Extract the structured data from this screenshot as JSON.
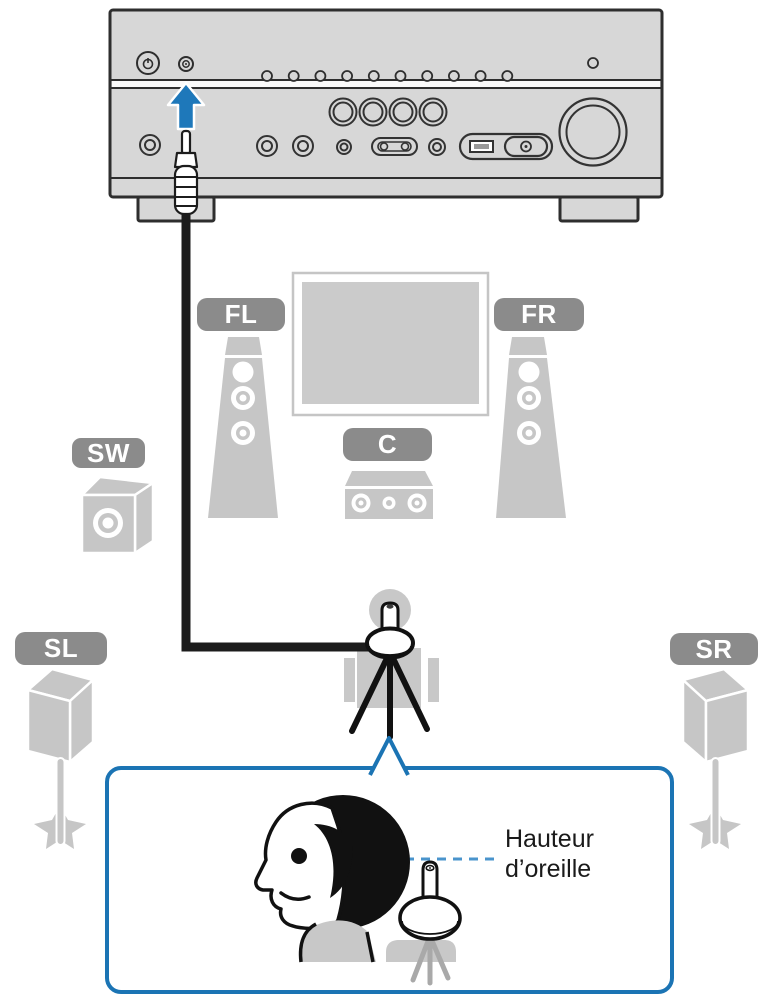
{
  "labels": {
    "front_left": "FL",
    "front_right": "FR",
    "center": "C",
    "subwoofer": "SW",
    "surround_left": "SL",
    "surround_right": "SR"
  },
  "callout": {
    "line1": "Hauteur",
    "line2": "d’oreille"
  },
  "colors": {
    "accent_blue": "#1e78ba",
    "callout_border": "#1b74b4",
    "dashed_line_blue": "#4a94cc",
    "label_badge_gray": "#8b8b8b",
    "speaker_gray": "#c6c6c6",
    "receiver_gray": "#d7d7d7",
    "cable_black": "#1c1c1c"
  },
  "icons": [
    "up-arrow-icon",
    "power-button-icon",
    "mic-jack-icon",
    "ypao-microphone-icon",
    "tripod-icon",
    "listener-head-icon",
    "sofa-icon"
  ]
}
